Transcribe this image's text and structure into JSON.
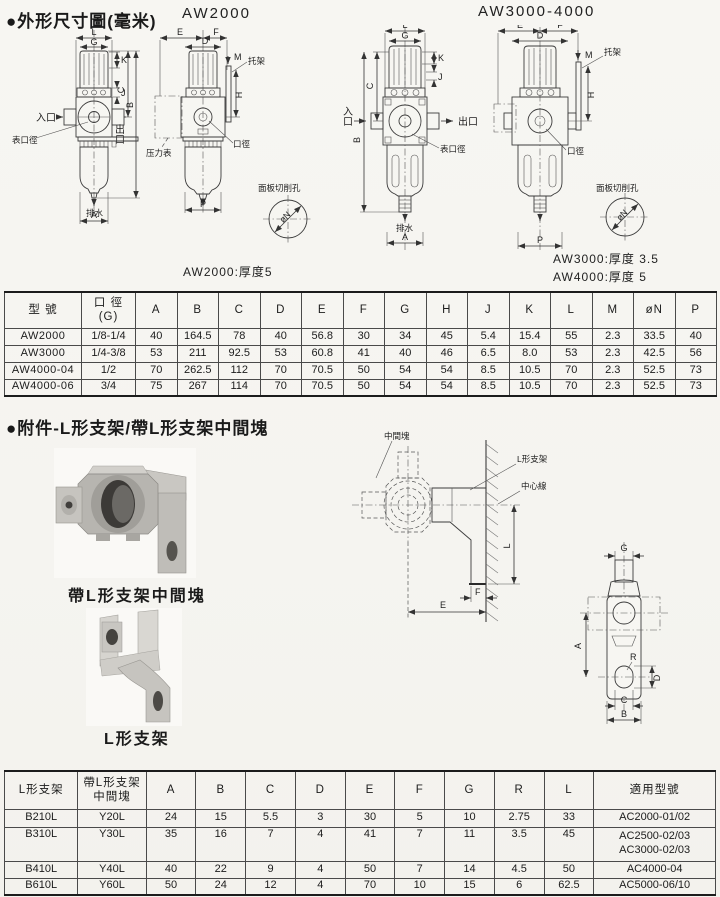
{
  "sections": {
    "dimensions_title": "●外形尺寸圖(毫米)",
    "accessories_title": "●附件-L形支架/帶L形支架中間塊"
  },
  "drawings": {
    "aw2000_title": "AW2000",
    "aw3000_title": "AW3000-4000",
    "aw2000_note": "AW2000:厚度5",
    "aw3000_note": "AW3000:厚度 3.5",
    "aw4000_note": "AW4000:厚度 5",
    "labels": {
      "inlet": "入口",
      "outlet": "出口",
      "gauge_port": "表口徑",
      "drain": "排水",
      "pressure_gauge": "压力表",
      "port": "口徑",
      "bracket": "托架",
      "panel_cutout": "面板切削孔",
      "phi_n": "øN",
      "intermediate_block": "中間塊",
      "l_bracket": "L形支架",
      "center_line": "中心線"
    },
    "dims": {
      "A": "A",
      "B": "B",
      "C": "C",
      "D": "D",
      "E": "E",
      "F": "F",
      "G": "G",
      "H": "H",
      "J": "J",
      "K": "K",
      "L": "L",
      "M": "M",
      "P": "P",
      "R": "R"
    }
  },
  "photos": {
    "bracket_with_block_caption": "帶L形支架中間塊",
    "l_bracket_caption": "L形支架"
  },
  "table1": {
    "h_model": "型  號",
    "h_port1": "口 徑",
    "h_port2": "(G)",
    "h_dims": [
      "A",
      "B",
      "C",
      "D",
      "E",
      "F",
      "G",
      "H",
      "J",
      "K",
      "L",
      "M",
      "øN",
      "P"
    ],
    "rows": [
      {
        "model": "AW2000",
        "port": "1/8-1/4",
        "vals": [
          "40",
          "164.5",
          "78",
          "40",
          "56.8",
          "30",
          "34",
          "45",
          "5.4",
          "15.4",
          "55",
          "2.3",
          "33.5",
          "40"
        ]
      },
      {
        "model": "AW3000",
        "port": "1/4-3/8",
        "vals": [
          "53",
          "211",
          "92.5",
          "53",
          "60.8",
          "41",
          "40",
          "46",
          "6.5",
          "8.0",
          "53",
          "2.3",
          "42.5",
          "56"
        ]
      },
      {
        "model": "AW4000-04",
        "port": "1/2",
        "vals": [
          "70",
          "262.5",
          "112",
          "70",
          "70.5",
          "50",
          "54",
          "54",
          "8.5",
          "10.5",
          "70",
          "2.3",
          "52.5",
          "73"
        ]
      },
      {
        "model": "AW4000-06",
        "port": "3/4",
        "vals": [
          "75",
          "267",
          "114",
          "70",
          "70.5",
          "50",
          "54",
          "54",
          "8.5",
          "10.5",
          "70",
          "2.3",
          "52.5",
          "73"
        ]
      }
    ]
  },
  "table2": {
    "h_bracket": "L形支架",
    "h_block1": "帶L形支架",
    "h_block2": "中間塊",
    "h_dims": [
      "A",
      "B",
      "C",
      "D",
      "E",
      "F",
      "G",
      "R",
      "L"
    ],
    "h_models": "適用型號",
    "rows": [
      {
        "bracket": "B210L",
        "block": "Y20L",
        "vals": [
          "24",
          "15",
          "5.5",
          "3",
          "30",
          "5",
          "10",
          "2.75",
          "33"
        ],
        "models": [
          "AC2000-01/02"
        ]
      },
      {
        "bracket": "B310L",
        "block": "Y30L",
        "vals": [
          "35",
          "16",
          "7",
          "4",
          "41",
          "7",
          "11",
          "3.5",
          "45"
        ],
        "models": [
          "AC2500-02/03",
          "AC3000-02/03"
        ]
      },
      {
        "bracket": "B410L",
        "block": "Y40L",
        "vals": [
          "40",
          "22",
          "9",
          "4",
          "50",
          "7",
          "14",
          "4.5",
          "50"
        ],
        "models": [
          "AC4000-04"
        ]
      },
      {
        "bracket": "B610L",
        "block": "Y60L",
        "vals": [
          "50",
          "24",
          "12",
          "4",
          "70",
          "10",
          "15",
          "6",
          "62.5"
        ],
        "models": [
          "AC5000-06/10"
        ]
      }
    ]
  }
}
